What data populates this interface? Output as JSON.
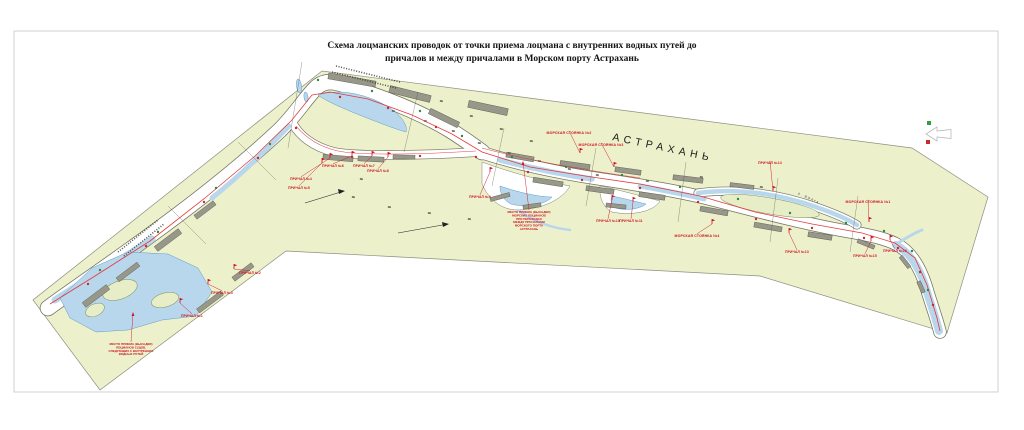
{
  "title": {
    "line1": "Схема лоцманских проводок от точки приема лоцмана с внутренних водных путей до",
    "line2": "причалов и между причалами в Морском порту  Астрахань"
  },
  "map": {
    "city_label": "АСТРАХАНЬ",
    "river_label": "р. ВОЛГА",
    "colors": {
      "land": "#ecf1cb",
      "water": "#b9d7ec",
      "channel_outline": "#72725f",
      "pier_gray": "#98988a",
      "route_red": "#e03131",
      "label_red": "#cf1020",
      "border": "#c6c6c6"
    },
    "legend": {
      "green": "#2f9e44",
      "red": "#c92a2a"
    },
    "berth_labels": [
      {
        "text": "ПРИЧАЛ №1",
        "x": 192,
        "y": 317,
        "ax": 180,
        "ay": 303
      },
      {
        "text": "ПРИЧАЛ №2",
        "x": 250,
        "y": 274,
        "ax": 234,
        "ay": 269
      },
      {
        "text": "ПРИЧАЛ №3",
        "x": 222,
        "y": 294,
        "ax": 208,
        "ay": 284
      },
      {
        "text": "ПРИЧАЛ №4",
        "x": 301,
        "y": 180,
        "ax": 330,
        "ay": 158
      },
      {
        "text": "ПРИЧАЛ №5",
        "x": 299,
        "y": 189,
        "ax": 322,
        "ay": 163
      },
      {
        "text": "ПРИЧАЛ №6",
        "x": 333,
        "y": 167,
        "ax": 352,
        "ay": 156
      },
      {
        "text": "ПРИЧАЛ №7",
        "x": 364,
        "y": 167,
        "ax": 372,
        "ay": 156
      },
      {
        "text": "ПРИЧАЛ №8",
        "x": 378,
        "y": 172,
        "ax": 388,
        "ay": 157
      },
      {
        "text": "ПРИЧАЛ №9",
        "x": 480,
        "y": 198,
        "ax": 490,
        "ay": 172
      },
      {
        "text": "ПРИЧАЛ №10",
        "x": 608,
        "y": 222,
        "ax": 612,
        "ay": 200
      },
      {
        "text": "ПРИЧАЛ №11",
        "x": 631,
        "y": 222,
        "ax": 633,
        "ay": 202
      },
      {
        "text": "ПРИЧАЛ №13",
        "x": 797,
        "y": 253,
        "ax": 789,
        "ay": 233
      },
      {
        "text": "ПРИЧАЛ №14",
        "x": 770,
        "y": 164,
        "ax": 773,
        "ay": 191
      },
      {
        "text": "ПРИЧАЛ №15",
        "x": 865,
        "y": 257,
        "ax": 871,
        "ay": 241
      },
      {
        "text": "ПРИЧАЛ №16",
        "x": 895,
        "y": 252,
        "ax": 890,
        "ay": 240
      }
    ],
    "anchorage_labels": [
      {
        "text": "МОРСКАЯ СТОЯНКА №2",
        "x": 569,
        "y": 134,
        "ax": 580,
        "ay": 153
      },
      {
        "text": "МОРСКАЯ СТОЯНКА №3",
        "x": 601,
        "y": 146,
        "ax": 614,
        "ay": 167
      },
      {
        "text": "МОРСКАЯ СТОЯНКА №1",
        "x": 868,
        "y": 203,
        "ax": 869,
        "ay": 222
      },
      {
        "text": "МОРСКАЯ СТОЯНКА №4",
        "x": 697,
        "y": 237,
        "ax": 712,
        "ay": 224
      }
    ],
    "notes": [
      {
        "x": 529,
        "y": 213,
        "ax": 523,
        "ay": 162,
        "lines": [
          "МЕСТО ПРИЕМА (ВЫСАДКИ)",
          "МОРСКИХ ЛОЦМАНОВ",
          "ПРИ ПЕРЕХОДАХ",
          "МЕЖДУ ПРИЧАЛАМИ",
          "МОРСКОГО ПОРТА",
          "АСТРАХАНЬ"
        ]
      },
      {
        "x": 131,
        "y": 345,
        "ax": 133,
        "ay": 313,
        "lines": [
          "МЕСТО ПРИЕМА (ВЫСАДКИ)",
          "ЛОЦМАНОВ СУДОВ,",
          "СЛЕДУЮЩИХ С ВНУТРЕННИХ",
          "ВОДНЫХ ПУТЕЙ"
        ]
      }
    ],
    "buoys": {
      "red": [
        [
          88,
          284
        ],
        [
          146,
          246
        ],
        [
          204,
          202
        ],
        [
          258,
          158
        ],
        [
          296,
          128
        ],
        [
          340,
          97
        ],
        [
          388,
          108
        ],
        [
          436,
          127
        ],
        [
          352,
          157
        ],
        [
          420,
          156
        ],
        [
          476,
          157
        ],
        [
          528,
          172
        ],
        [
          582,
          180
        ],
        [
          640,
          188
        ],
        [
          698,
          202
        ],
        [
          756,
          219
        ],
        [
          812,
          228
        ],
        [
          864,
          238
        ],
        [
          898,
          248
        ],
        [
          920,
          272
        ],
        [
          933,
          305
        ]
      ],
      "green": [
        [
          100,
          270
        ],
        [
          158,
          232
        ],
        [
          216,
          188
        ],
        [
          270,
          144
        ],
        [
          318,
          80
        ],
        [
          372,
          91
        ],
        [
          420,
          111
        ],
        [
          462,
          136
        ],
        [
          512,
          157
        ],
        [
          566,
          167
        ],
        [
          622,
          175
        ],
        [
          680,
          187
        ],
        [
          738,
          199
        ],
        [
          790,
          213
        ],
        [
          846,
          223
        ],
        [
          884,
          231
        ],
        [
          912,
          251
        ],
        [
          928,
          290
        ]
      ]
    }
  }
}
